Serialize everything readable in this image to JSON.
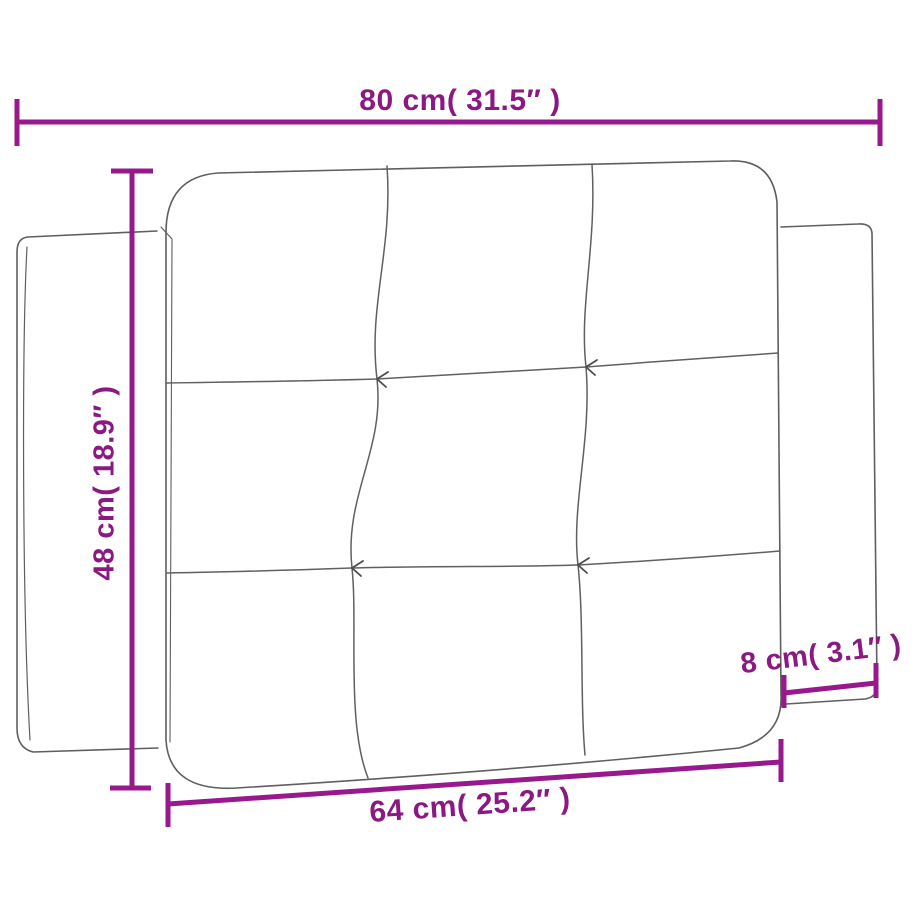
{
  "page": {
    "title": "Headboard cushion dimension diagram",
    "background": "#ffffff"
  },
  "colors": {
    "dimension_text": "#8a1982",
    "dimension_line": "#98198e",
    "drawing_outline": "#5f5f5f"
  },
  "drawing": {
    "subject": "tufted headboard cushion with left and right side flaps",
    "tufting_grid": "3×3"
  },
  "dimensions": {
    "top_width": {
      "label": "80 cm( 31.5″ )",
      "value_cm": 80,
      "value_in": 31.5
    },
    "left_height": {
      "label": "48 cm( 18.9″ )",
      "value_cm": 48,
      "value_in": 18.9
    },
    "bottom_width": {
      "label": "64 cm( 25.2″ )",
      "value_cm": 64,
      "value_in": 25.2
    },
    "right_depth": {
      "label": "8 cm( 3.1″ )",
      "value_cm": 8,
      "value_in": 3.1
    }
  }
}
